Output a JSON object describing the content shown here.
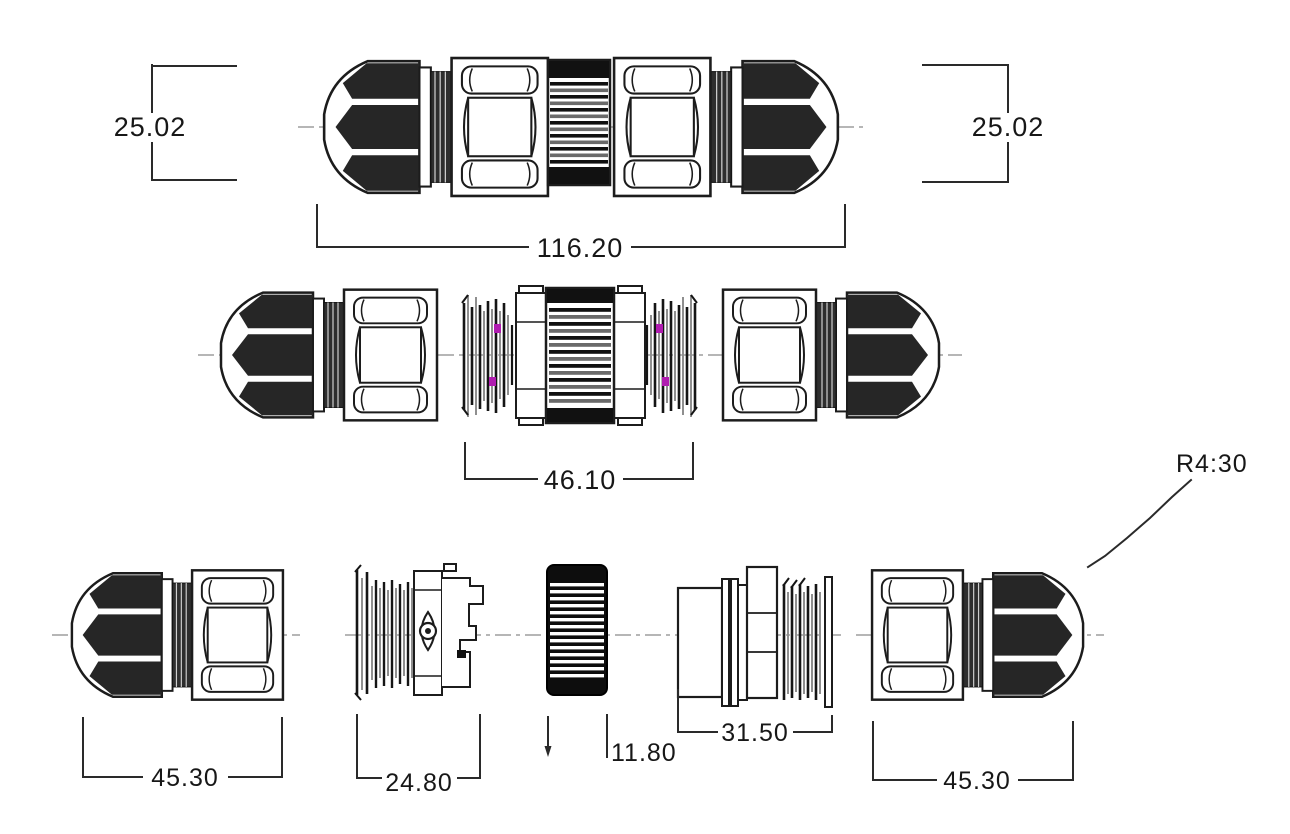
{
  "drawing": {
    "type": "engineering-drawing",
    "subject": "waterproof-inline-cable-connector",
    "background_color": "#ffffff",
    "line_color": "#1c1c1c",
    "accent_color": "#b01cb0",
    "dims": {
      "assembled_height_left": "25.02",
      "assembled_height_right": "25.02",
      "assembled_length": "116.20",
      "core_length": "46.10",
      "gland_length_left": "45.30",
      "insert_length": "24.80",
      "sleeve_diameter": "11.80",
      "socket_length": "31.50",
      "gland_length_right": "45.30",
      "dome_radius": "R4:30"
    }
  }
}
